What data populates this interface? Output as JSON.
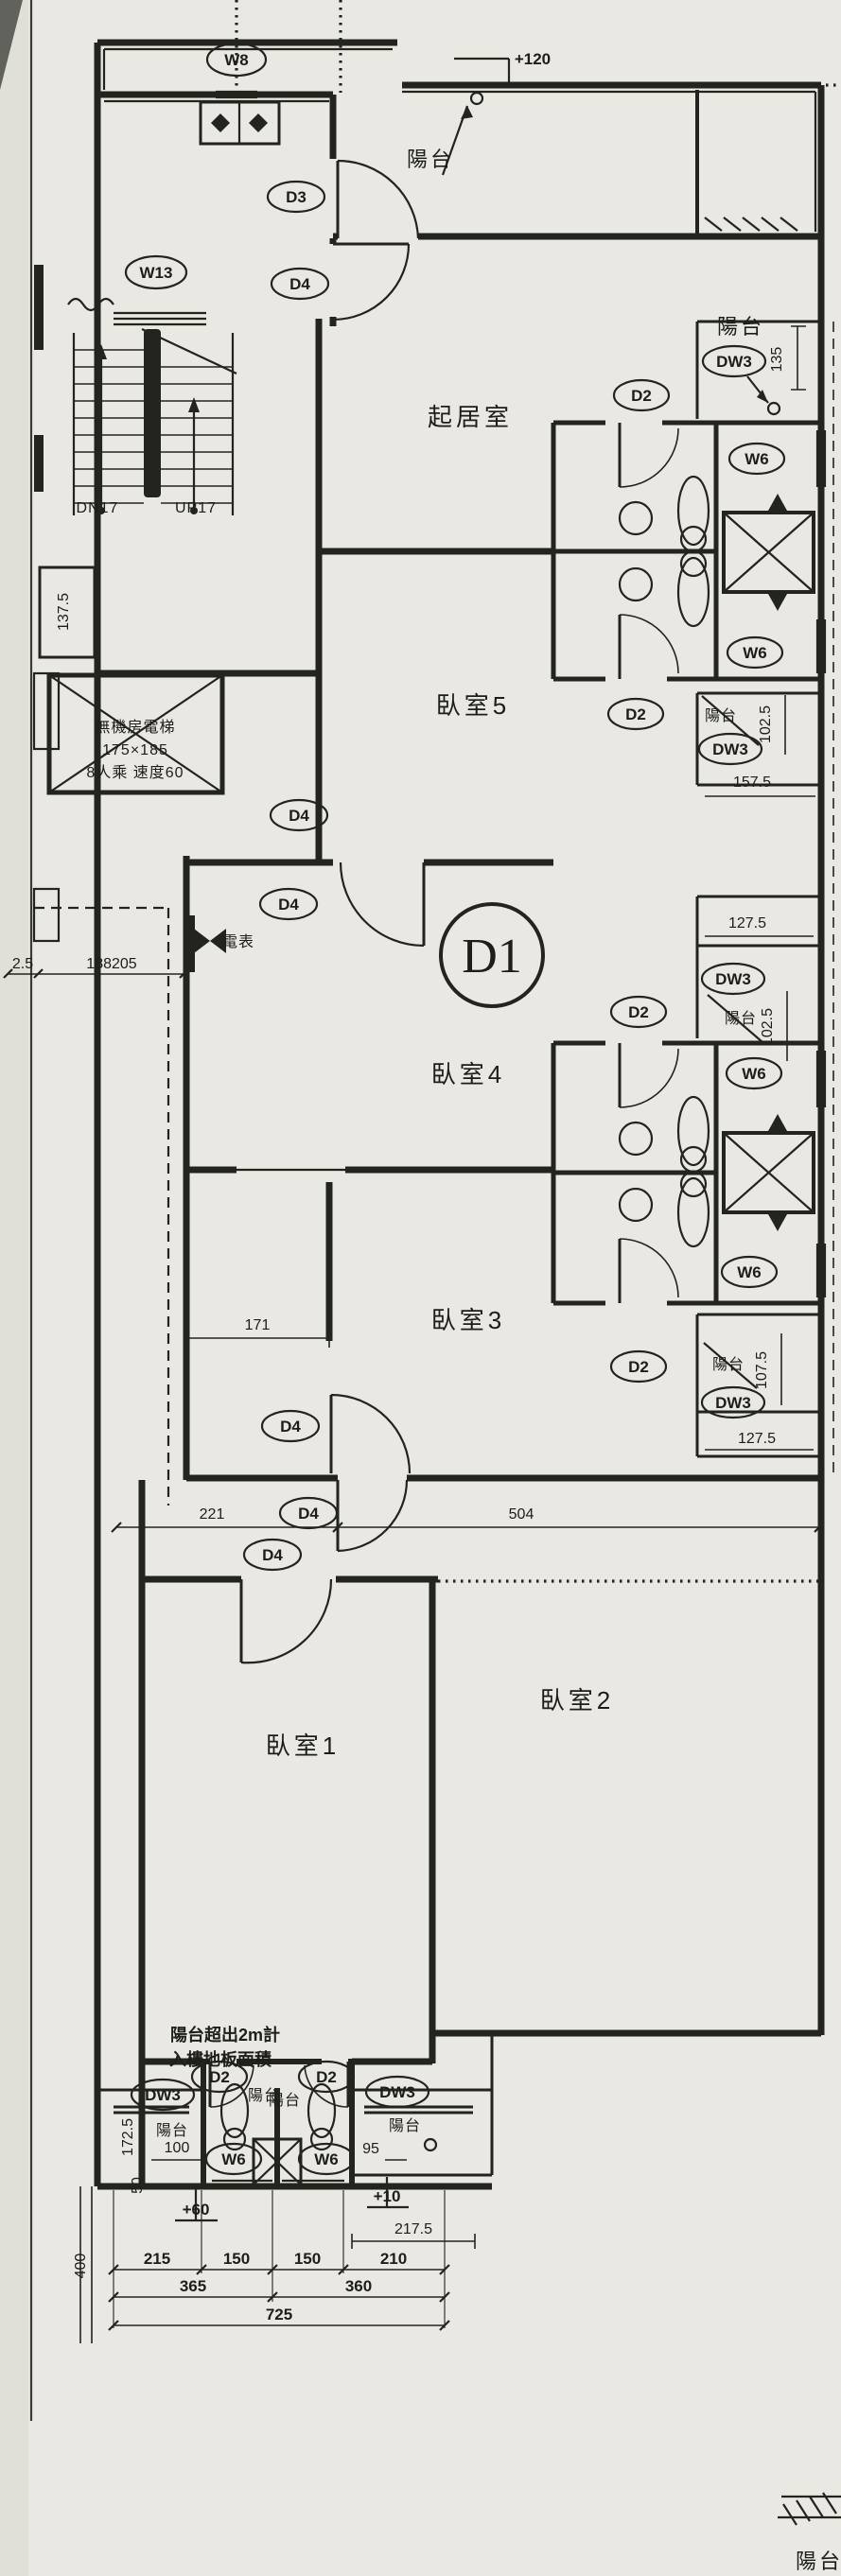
{
  "colors": {
    "paper": "#e9e8e2",
    "ink": "#24241f"
  },
  "unit": {
    "id": "D1"
  },
  "rooms": {
    "living": "起居室",
    "bed1": "臥室1",
    "bed2": "臥室2",
    "bed3": "臥室3",
    "bed4": "臥室4",
    "bed5": "臥室5",
    "balcony": "陽台"
  },
  "stair": {
    "down": "DN17",
    "up": "UP17"
  },
  "elevator": {
    "line1": "無機房電梯",
    "line2": "175×185",
    "line3": "8人乘 速度60"
  },
  "meter_label": "電表",
  "note": {
    "line1": "陽台超出2m計",
    "line2": "入樓地板面積"
  },
  "tags": {
    "w8": "W8",
    "w13": "W13",
    "w6": "W6",
    "d1": "D1",
    "d2": "D2",
    "d3": "D3",
    "d4": "D4",
    "dw3": "DW3"
  },
  "levels": {
    "top": "+120",
    "left": "+60",
    "right": "+10"
  },
  "dims": {
    "a137_5": "137.5",
    "a2_5": "2.5",
    "a188205": "188205",
    "a135": "135",
    "a157_5": "157.5",
    "a102_5": "102.5",
    "a127_5": "127.5",
    "a107_5": "107.5",
    "a171": "171",
    "a221": "221",
    "a504": "504",
    "a172_5": "172.5",
    "a100": "100",
    "a95": "95",
    "a50": "50",
    "a215": "215",
    "a150": "150",
    "a210": "210",
    "a365": "365",
    "a360": "360",
    "a725": "725",
    "a400": "400",
    "a217_5": "217.5"
  }
}
